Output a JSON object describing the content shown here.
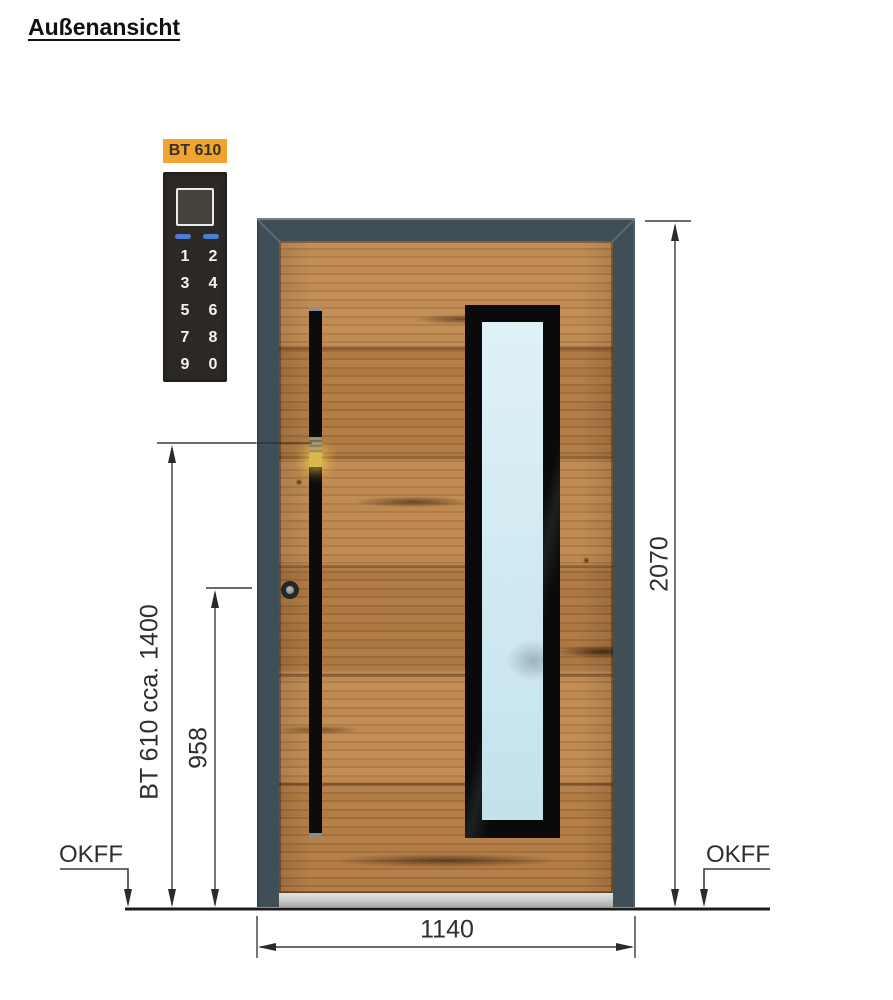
{
  "page": {
    "title": "Außenansicht"
  },
  "keypad": {
    "label": "BT 610",
    "keys": [
      "1",
      "2",
      "3",
      "4",
      "5",
      "6",
      "7",
      "8",
      "9",
      "0"
    ]
  },
  "dims": {
    "overall_height": "2070",
    "overall_width": "1140",
    "keypad_height_label": "BT 610 cca. 1400",
    "lock_height": "958",
    "floor_left": "OKFF",
    "floor_right": "OKFF"
  },
  "colors": {
    "frame": "#404e57",
    "wood_base": "#b27a42",
    "glass": "#cfe9f1",
    "handle": "#0c0c0c",
    "keypad_label_bg": "#f2a430",
    "keypad_panel": "#2c2925",
    "keypad_led": "#4b7fd5",
    "reader_glow": "#d8b94a",
    "dimension_line": "#3c3c3c"
  }
}
